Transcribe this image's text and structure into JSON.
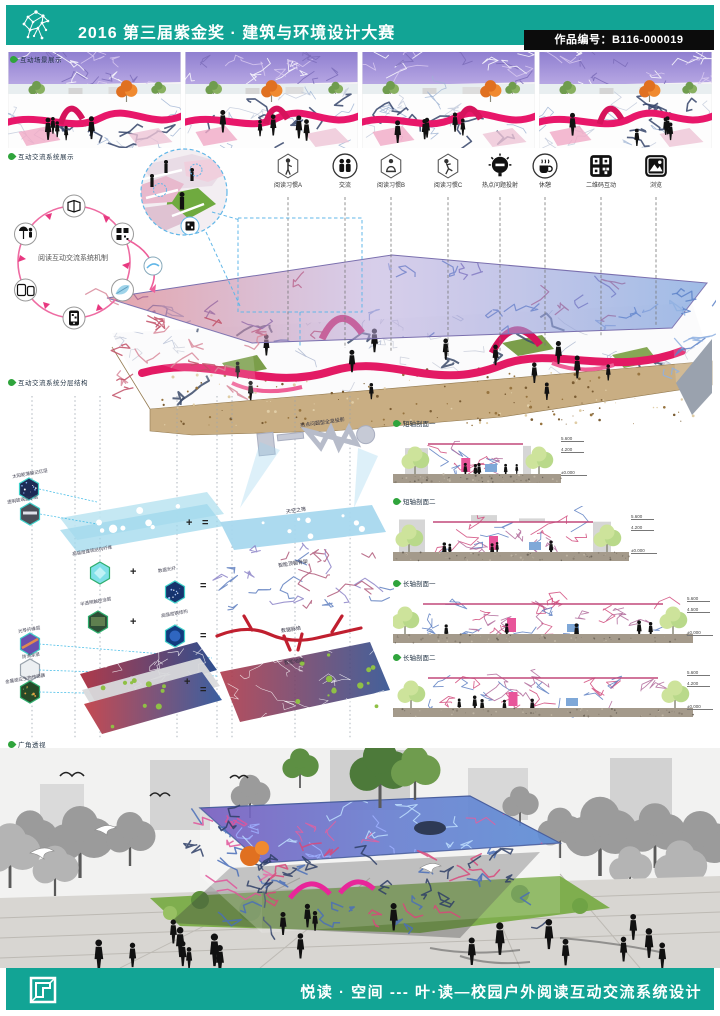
{
  "header": {
    "title": "2016 第三届紫金奖 · 建筑与环境设计大赛",
    "badge": "作品编号：B116-000019"
  },
  "labels": {
    "scene": "互动场景展示",
    "mechanism": "互动交流系统展示",
    "exploded": "互动交流系统分层结构",
    "perspective": "广角透视"
  },
  "icons_row": [
    {
      "name": "reading-habit-a",
      "label": "阅读习惯A"
    },
    {
      "name": "communication",
      "label": "交流"
    },
    {
      "name": "reading-habit-b",
      "label": "阅读习惯B"
    },
    {
      "name": "reading-habit-c",
      "label": "阅读习惯C"
    },
    {
      "name": "hotspot-projection",
      "label": "热点问题投射"
    },
    {
      "name": "rest",
      "label": "休憩"
    },
    {
      "name": "qrcode-interaction",
      "label": "二维码互动"
    },
    {
      "name": "browse",
      "label": "浏览"
    }
  ],
  "mechanism": {
    "center": "阅读互动交流系统机制"
  },
  "exploded": {
    "holo": "热点问题型全息投影",
    "plus": "+",
    "equals": "=",
    "materials": [
      "太阳能薄膜记忆层",
      "透明玻璃显示层",
      "高强度建筑结构纤维",
      "数据光纤",
      "半透明触控涂层",
      "高强度钢结构",
      "光导纤维层",
      "防滑涂层",
      "金属感应生物传感器"
    ],
    "layers": [
      "天空之筛",
      "智能顶棚骨架",
      "数据脉络",
      "智能地面"
    ]
  },
  "sections_right": [
    {
      "label": "短轴剖面一",
      "marks": [
        "5.600",
        "4.200",
        "±0.000"
      ]
    },
    {
      "label": "短轴剖面二",
      "marks": [
        "5.600",
        "4.200",
        "±0.000"
      ]
    },
    {
      "label": "长轴剖面一",
      "marks": [
        "5.600",
        "4.500",
        "±0.000"
      ]
    },
    {
      "label": "长轴剖面二",
      "marks": [
        "5.600",
        "4.200",
        "±0.000"
      ]
    }
  ],
  "footer": {
    "title": "悦读 · 空间 --- 叶·读—校园户外阅读互动交流系统设计"
  },
  "colors": {
    "teal": "#12a495",
    "magenta": "#e31a64",
    "canopy_blue": "#5f8fd6",
    "canopy_red": "#d05a66",
    "earth": "#c9ae83"
  }
}
